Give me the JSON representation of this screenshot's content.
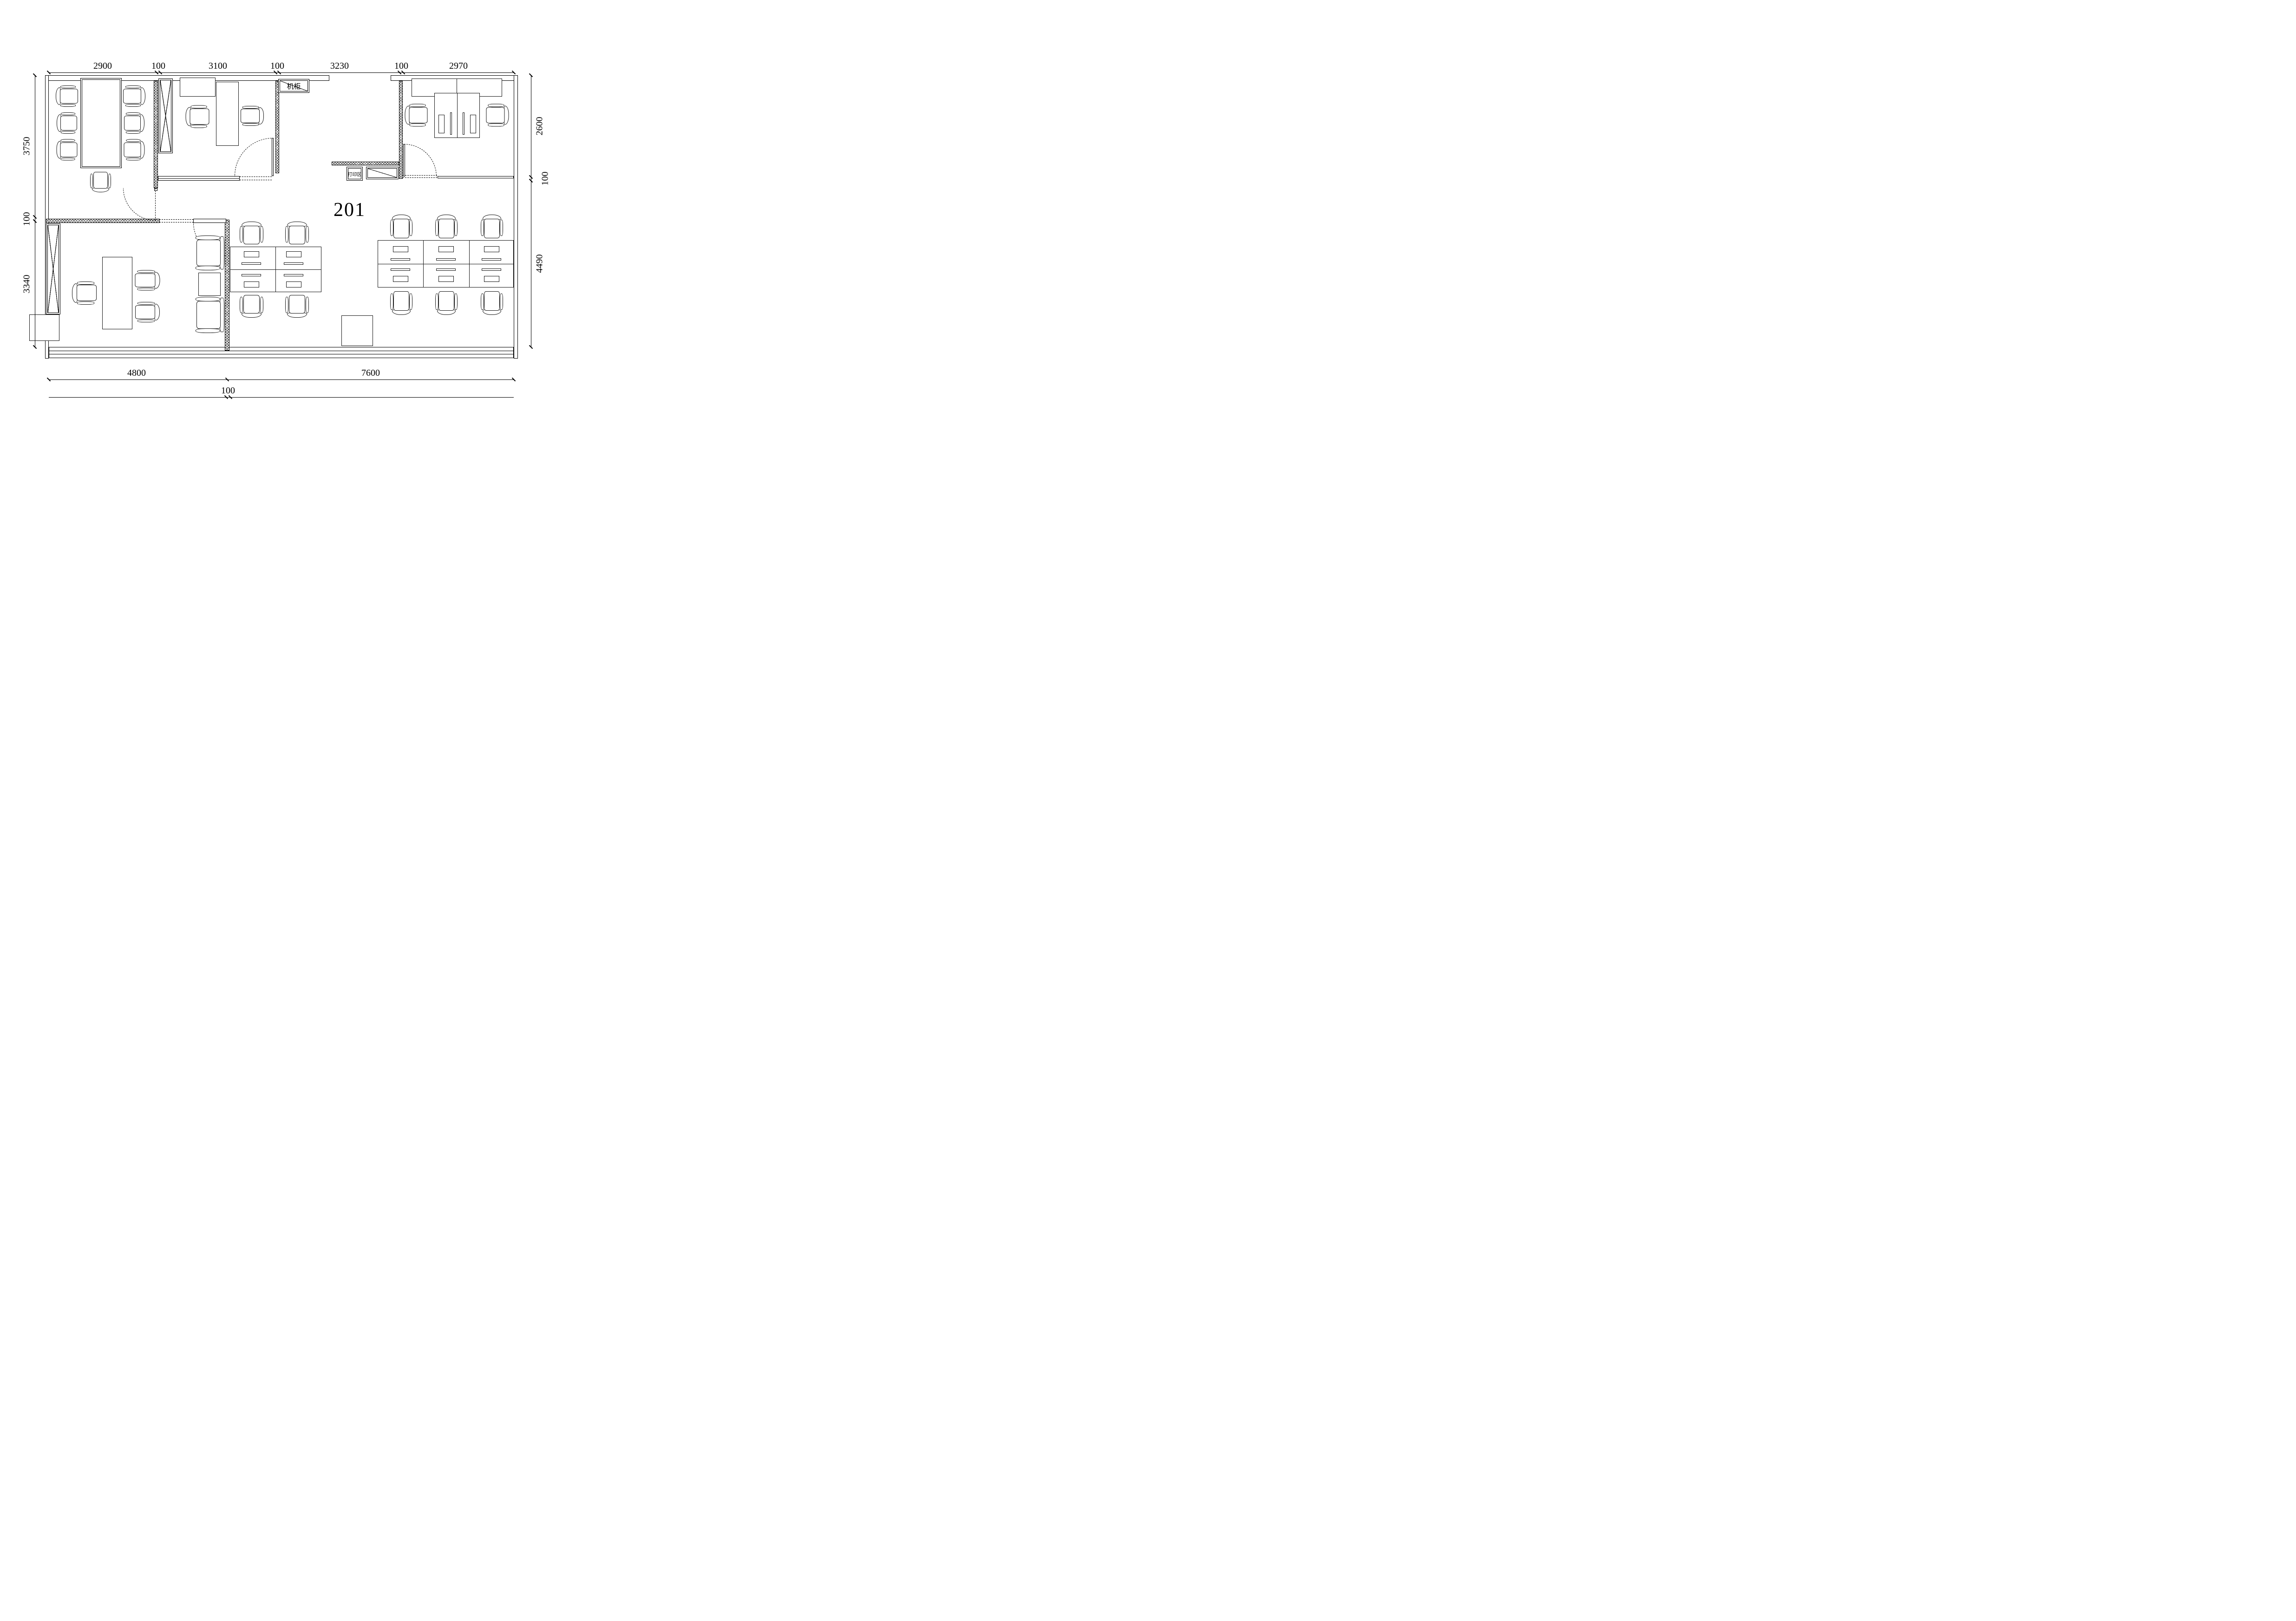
{
  "drawing": {
    "room_number": "201",
    "server_cabinet_label": "机柜",
    "print_area_label": "打印区"
  },
  "dimensions": {
    "top": [
      "2900",
      "100",
      "3100",
      "100",
      "3230",
      "100",
      "2970"
    ],
    "left": [
      "3750",
      "100",
      "3340"
    ],
    "right": [
      "2600",
      "100",
      "4490"
    ],
    "bottom": [
      "4800",
      "7600"
    ],
    "bottom_offset": [
      "100"
    ]
  }
}
